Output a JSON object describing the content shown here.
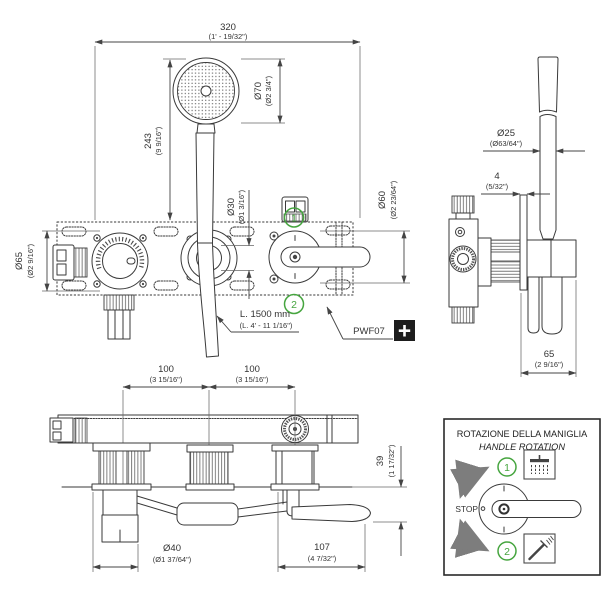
{
  "front_view": {
    "width": {
      "mm": "320",
      "in": "(1' - 19/32\")"
    },
    "head_diameter": {
      "mm": "Ø70",
      "in": "(Ø2 3/4\")"
    },
    "height": {
      "mm": "243",
      "in": "(9 9/16\")"
    },
    "trim_diameter": {
      "mm": "Ø65",
      "in": "(Ø2 9/16\")"
    },
    "outlet_diameter": {
      "mm": "Ø30",
      "in": "(Ø1 3/16\")"
    },
    "handle_diameter": {
      "mm": "Ø60",
      "in": "(Ø2 23/64\")"
    },
    "hose_length": {
      "mm": "L. 1500 mm",
      "in": "(L. 4' - 11 1/16\")"
    },
    "product_code": "PWF07",
    "marker_1": "1",
    "marker_2": "2"
  },
  "side_view": {
    "rod_diameter": {
      "mm": "Ø25",
      "in": "(Ø63/64\")"
    },
    "plate_thickness": {
      "mm": "4",
      "in": "(5/32\")"
    },
    "depth": {
      "mm": "65",
      "in": "(2 9/16\")"
    }
  },
  "bottom_view": {
    "spacing_left": {
      "mm": "100",
      "in": "(3 15/16\")"
    },
    "spacing_right": {
      "mm": "100",
      "in": "(3 15/16\")"
    },
    "body_height": {
      "mm": "39",
      "in": "(1 17/32\")"
    },
    "outlet_diameter": {
      "mm": "Ø40",
      "in": "(Ø1 37/64\")"
    },
    "lever_projection": {
      "mm": "107",
      "in": "(4 7/32\")"
    }
  },
  "legend": {
    "title_it": "ROTAZIONE DELLA MANIGLIA",
    "title_en": "HANDLE ROTATION",
    "stop_label": "STOP",
    "marker_1": "1",
    "marker_2": "2",
    "icon_1": "rain-shower-icon",
    "icon_2": "hand-shower-icon"
  },
  "colors": {
    "marker_green": "#46a53f",
    "arrow_gray": "#7d7d7d",
    "line_dark": "#3a3a3a"
  }
}
